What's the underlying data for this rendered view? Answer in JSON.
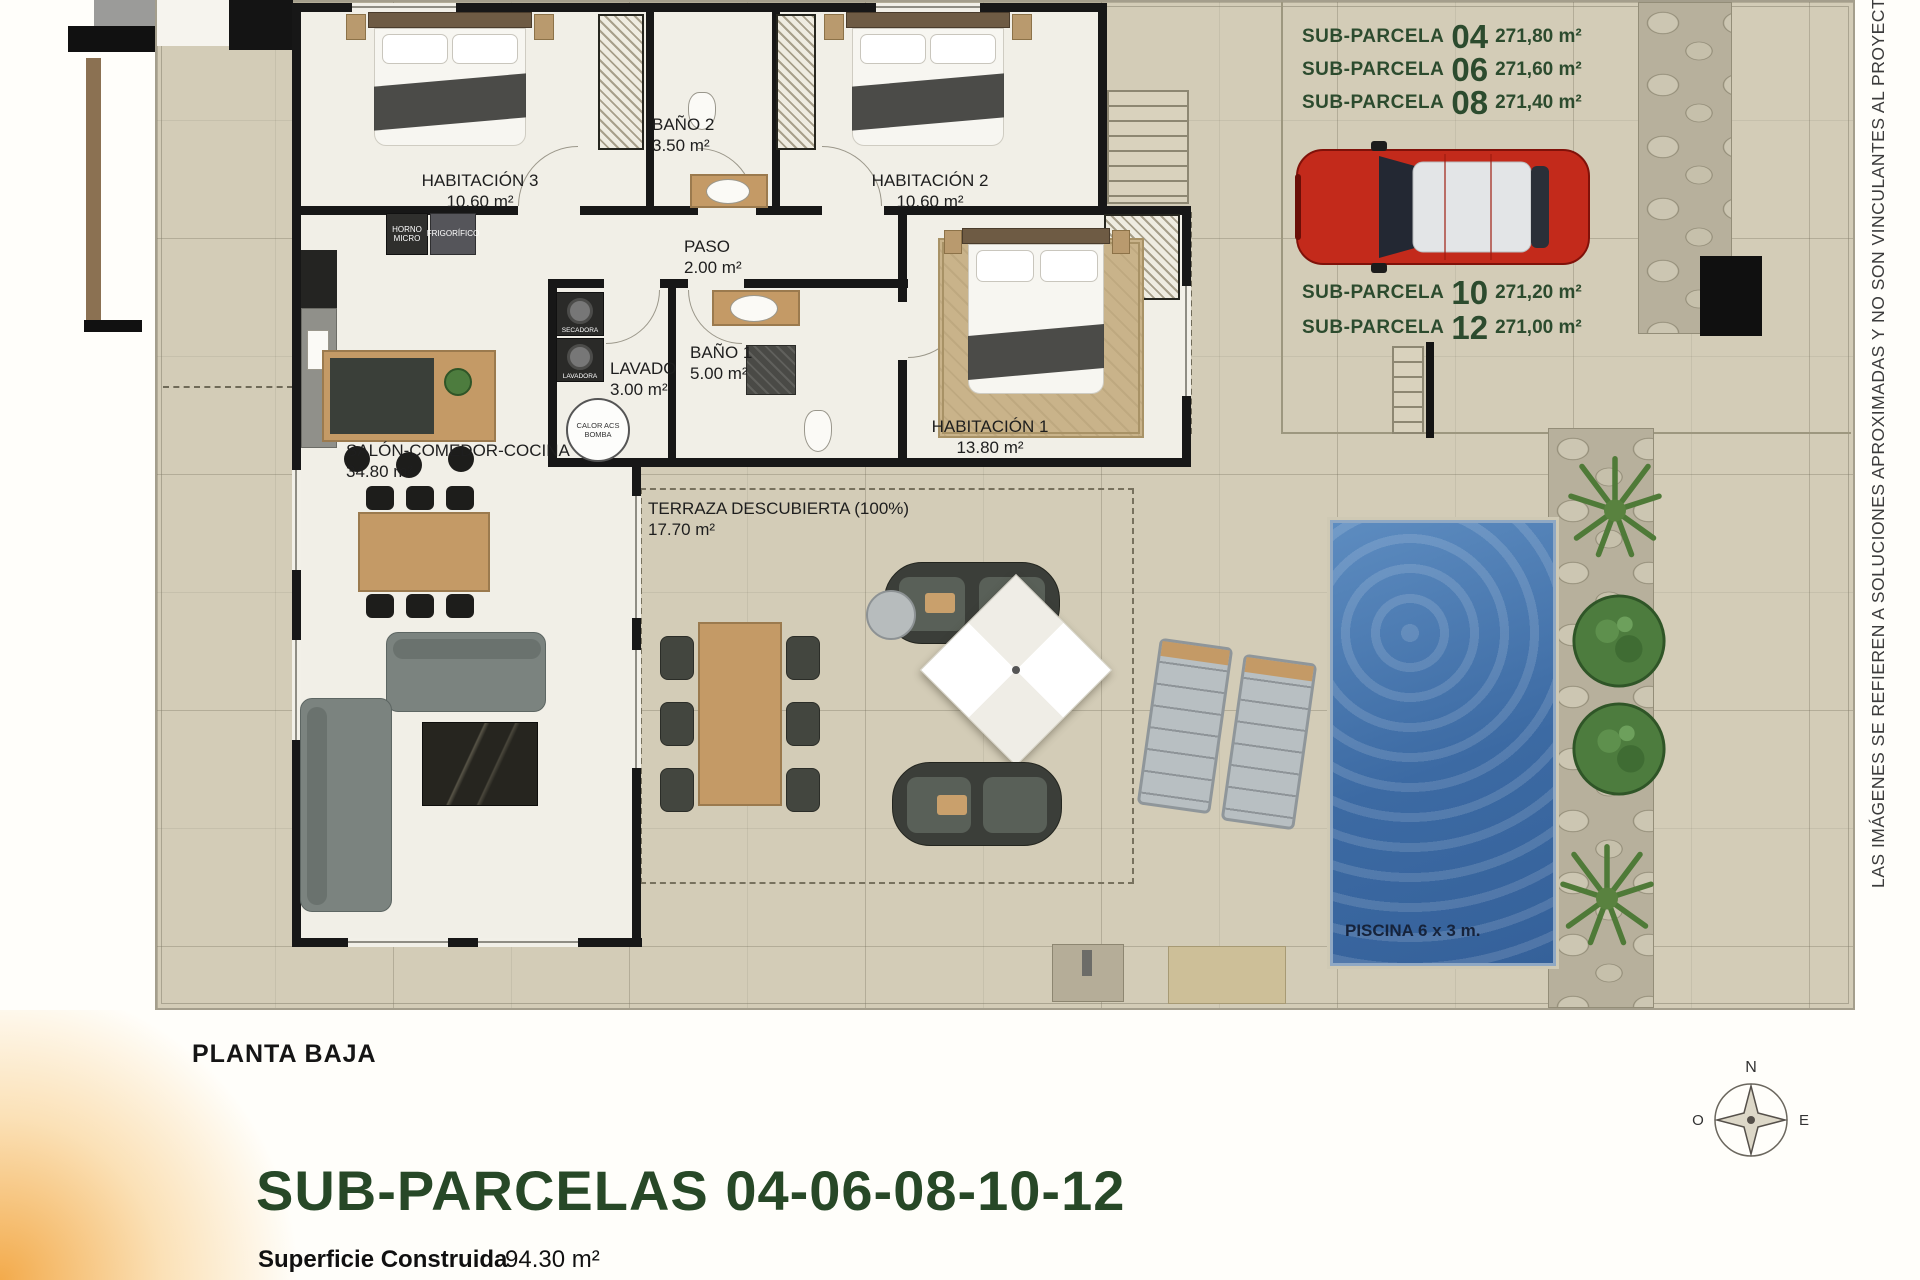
{
  "parcel_labels": {
    "color": "#2c4b2e",
    "top": [
      {
        "label": "SUB-PARCELA",
        "number": "04",
        "area": "271,80 m²"
      },
      {
        "label": "SUB-PARCELA",
        "number": "06",
        "area": "271,60 m²"
      },
      {
        "label": "SUB-PARCELA",
        "number": "08",
        "area": "271,40 m²"
      }
    ],
    "bottom": [
      {
        "label": "SUB-PARCELA",
        "number": "10",
        "area": "271,20 m²"
      },
      {
        "label": "SUB-PARCELA",
        "number": "12",
        "area": "271,00 m²"
      }
    ]
  },
  "rooms": {
    "habitacion3": {
      "name": "HABITACIÓN 3",
      "area": "10.60 m²"
    },
    "bano2": {
      "name": "BAÑO 2",
      "area": "3.50 m²"
    },
    "habitacion2": {
      "name": "HABITACIÓN 2",
      "area": "10.60 m²"
    },
    "paso": {
      "name": "PASO",
      "area": "2.00 m²"
    },
    "lavado": {
      "name": "LAVADO",
      "area": "3.00 m²"
    },
    "bano1": {
      "name": "BAÑO 1",
      "area": "5.00 m²"
    },
    "habitacion1": {
      "name": "HABITACIÓN 1",
      "area": "13.80 m²"
    },
    "salon": {
      "name": "SALÓN-COMEDOR-COCINA",
      "area": "34.80 m²"
    },
    "terraza": {
      "name": "TERRAZA DESCUBIERTA (100%)",
      "area": "17.70 m²"
    },
    "piscina": {
      "name": "PISCINA 6 x 3 m."
    }
  },
  "appliances": {
    "horno": "HORNO MICRO",
    "frigorifico": "FRIGORÍFICO",
    "secadora": "SECADORA",
    "lavadora": "LAVADORA",
    "calor_acs": "CALOR ACS BOMBA"
  },
  "sidebar_note": "LAS IMÁGENES SE REFIEREN A SOLUCIONES APROXIMADAS Y NO SON VINCULANTES AL PROYECT",
  "footer": {
    "plan_title": "PLANTA BAJA",
    "heading": "SUB-PARCELAS 04-06-08-10-12",
    "superficie_label": "Superficie Construida",
    "superficie_value": "94.30 m²"
  },
  "compass": {
    "north": "N",
    "west": "O",
    "east": "E"
  },
  "colors": {
    "heading_green": "#2c4b2e",
    "pool_blue": "#41699f",
    "car_red": "#c32a1b",
    "tile_beige": "#d3ccb7"
  }
}
